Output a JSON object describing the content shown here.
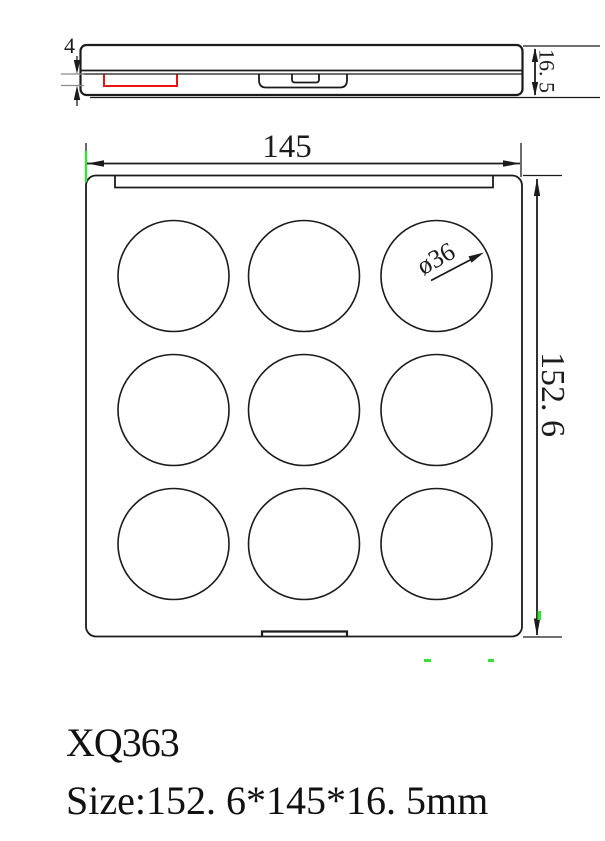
{
  "page": {
    "background": "#ffffff"
  },
  "title_block": {
    "product_code": "XQ363",
    "size_line": "Size:152. 6*145*16. 5mm"
  },
  "dimensions": {
    "overall_width": "145",
    "overall_height": "152. 6",
    "profile_thickness": "16. 5",
    "pan_depth": "4",
    "well_diameter": "ø36"
  },
  "wells": {
    "rows": 3,
    "cols": 3,
    "count": 9
  },
  "colors": {
    "line_color": "#1b1b1b",
    "highlight_red": "#e81313",
    "artifact_green": "#35e135"
  }
}
